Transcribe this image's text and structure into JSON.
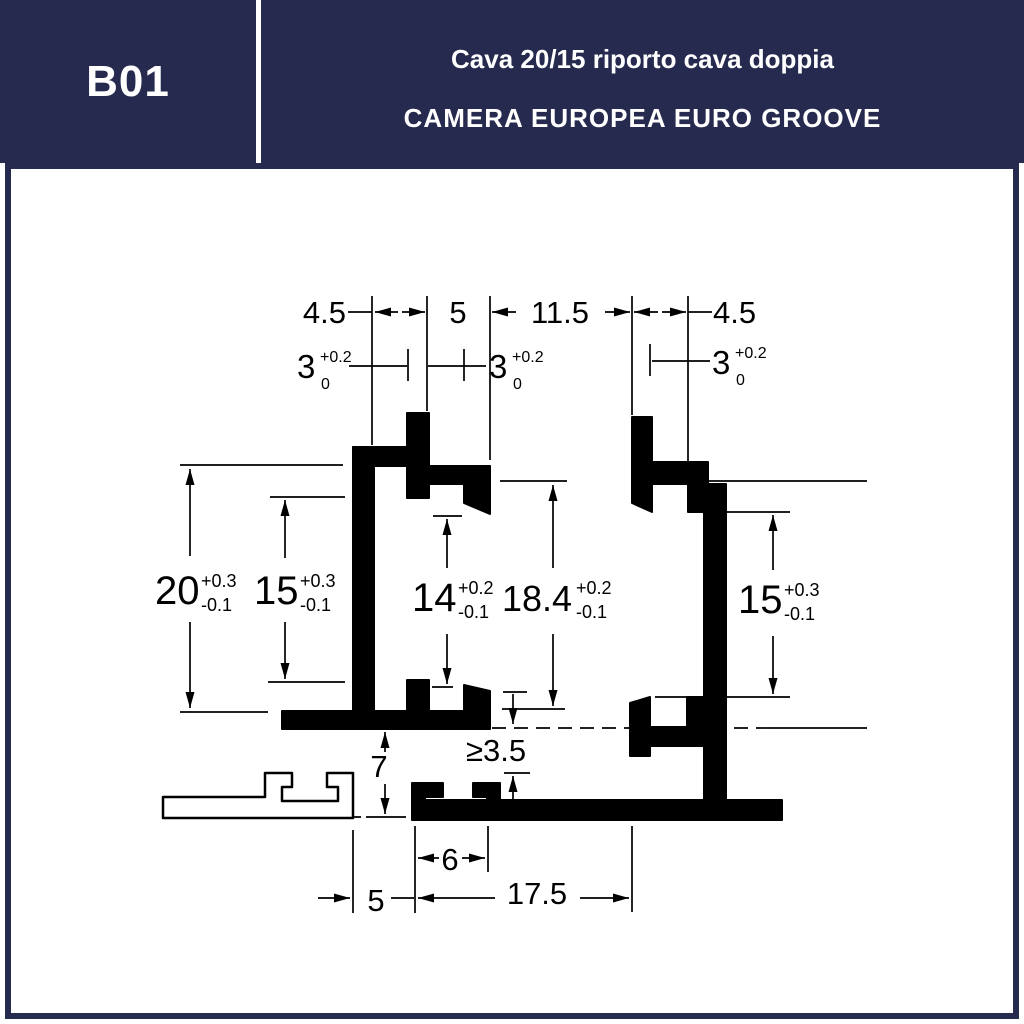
{
  "header": {
    "code": "B01",
    "title_line1": "Cava 20/15 riporto cava doppia",
    "title_line2": "CAMERA EUROPEA EURO GROOVE"
  },
  "colors": {
    "navy": "#262a4e",
    "line": "#000000",
    "bg": "#ffffff"
  },
  "drawing": {
    "description": "Euro groove aluminium profile cross-section, technical dimension drawing",
    "dims": {
      "top_w1": "4.5",
      "top_w2": "5",
      "top_w3": "11.5",
      "top_w4": "4.5",
      "slot_left": {
        "v": "3",
        "plus": "+0.2",
        "minus": "0"
      },
      "slot_mid": {
        "v": "3",
        "plus": "+0.2",
        "minus": "0"
      },
      "slot_right": {
        "v": "3",
        "plus": "+0.2",
        "minus": "0"
      },
      "h20": {
        "v": "20",
        "plus": "+0.3",
        "minus": "-0.1"
      },
      "h15_left": {
        "v": "15",
        "plus": "+0.3",
        "minus": "-0.1"
      },
      "h14": {
        "v": "14",
        "plus": "+0.2",
        "minus": "-0.1"
      },
      "h18_4": {
        "v": "18.4",
        "plus": "+0.2",
        "minus": "-0.1"
      },
      "h15_right": {
        "v": "15",
        "plus": "+0.3",
        "minus": "-0.1"
      },
      "h7": "7",
      "gap_min": "≥3.5",
      "w6": "6",
      "w5": "5",
      "w17_5": "17.5"
    }
  }
}
